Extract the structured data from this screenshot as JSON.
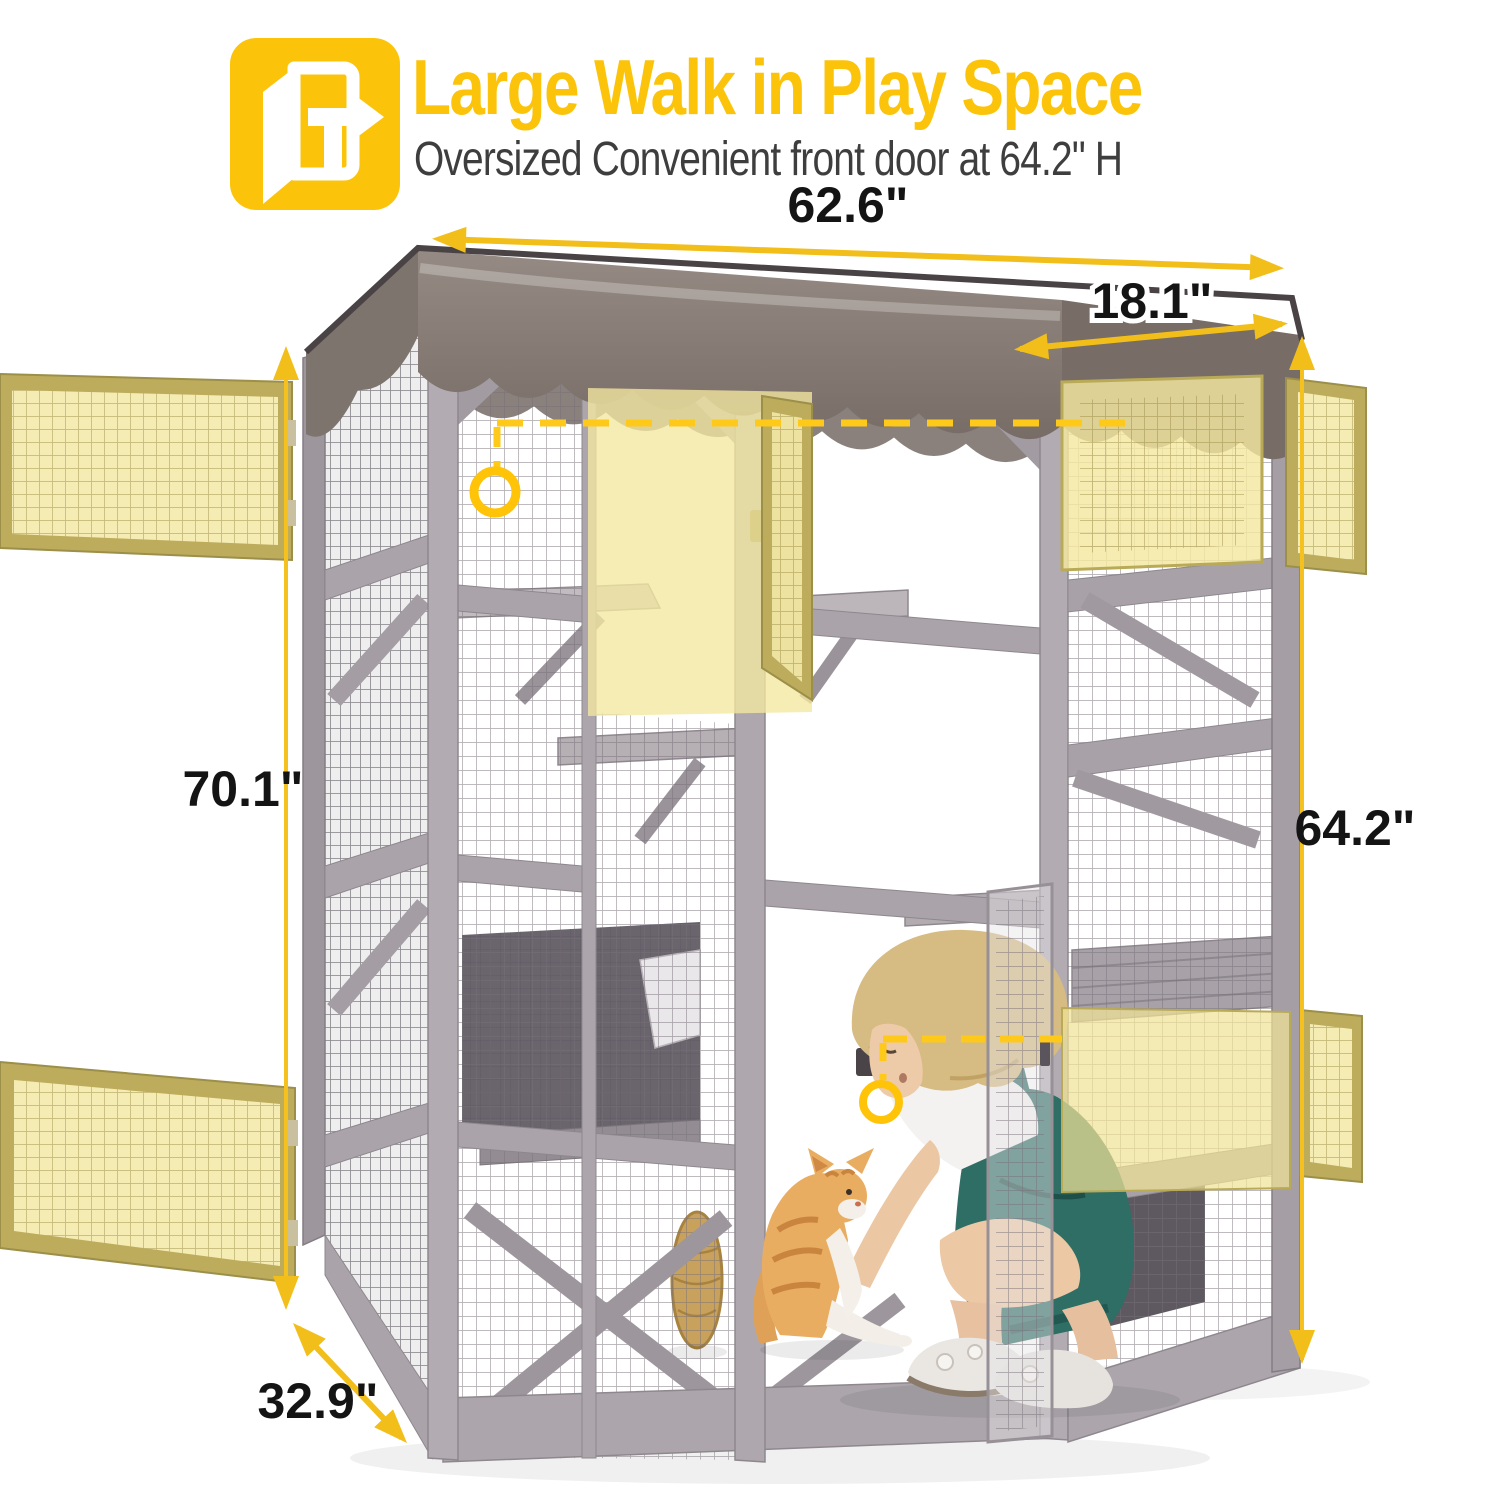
{
  "header": {
    "title": "Large Walk in Play Space",
    "subtitle": "Oversized Convenient front door at 64.2\" H",
    "icon": "walk-in-door-icon"
  },
  "dimensions": {
    "top_width": "62.6\"",
    "top_depth": "18.1\"",
    "left_height": "70.1\"",
    "right_height": "64.2\"",
    "bottom_depth": "32.9\""
  },
  "colors": {
    "accent_yellow": "#FBC40B",
    "arrow_gold": "#F2BE1A",
    "callout_yellow": "#FFC91A",
    "door_highlight_fill": "#F5ECB4",
    "door_frame_tan": "#B3A456",
    "roof_taupe": "#8A7F78",
    "frame_gray": "#B0AAB0",
    "subtitle_gray": "#3E3E3E"
  }
}
